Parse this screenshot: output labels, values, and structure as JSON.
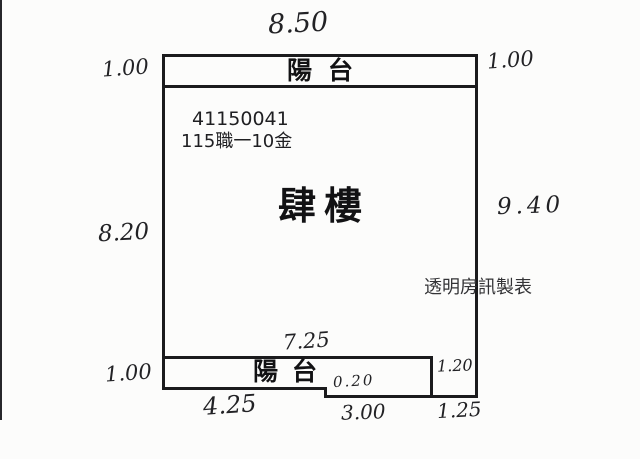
{
  "canvas": {
    "background": "#fcfcfb",
    "line_color": "#1b1b1d"
  },
  "plan": {
    "top_width": "8.50",
    "balcony_top": {
      "label": "陽台",
      "left_depth": "1.00",
      "right_depth": "1.00"
    },
    "unit_number": "41150041",
    "unit_code": "115職一10金",
    "floor_label": "肆樓",
    "left_height": "8.20",
    "right_height": "9.40",
    "watermark": "透明房訊製表",
    "inner_width": "7.25",
    "balcony_bottom": {
      "label": "陽台",
      "left_depth": "1.00",
      "right_depth": "1.20",
      "step": "0.20"
    },
    "bottom_segments": [
      "4.25",
      "3.00",
      "1.25"
    ]
  }
}
